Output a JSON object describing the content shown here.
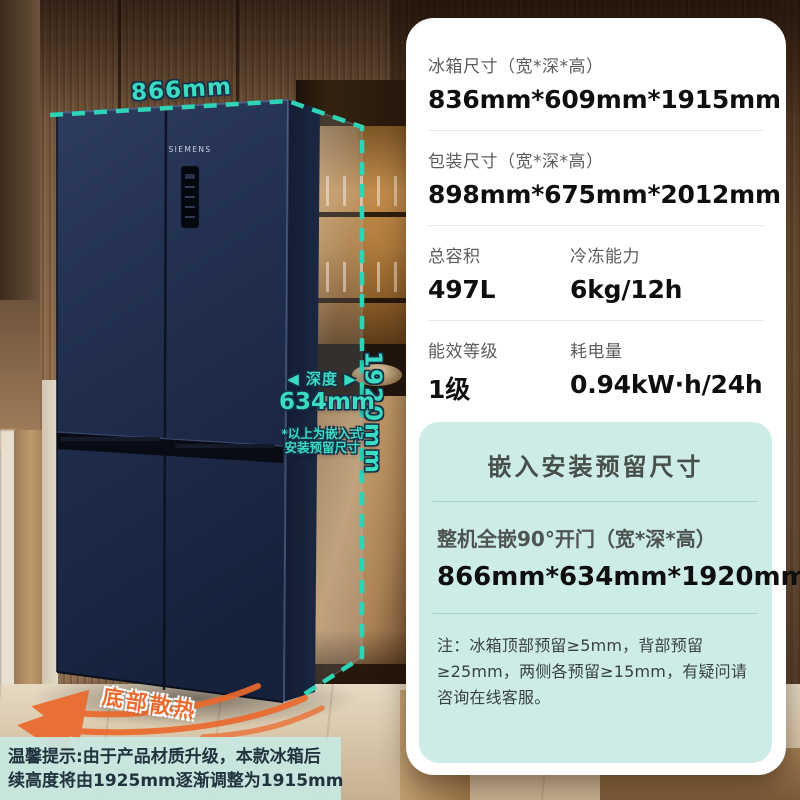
{
  "colors": {
    "accent_teal": "#3BDCC0",
    "dashed_line_teal": "#2FD3B6",
    "orange": "#EB6A2D",
    "embed_card_bg": "#CDECE7",
    "fridge_navy": "#1F2B4A"
  },
  "fridge": {
    "brand": "SIEMENS"
  },
  "measurements": {
    "width": "866mm",
    "height": "1920mm",
    "depth_dir": "◀ 深度 ▶",
    "depth_value": "634mm",
    "embed_note_line1": "*以上为嵌入式",
    "embed_note_line2": "安装预留尺寸",
    "vent": "底部散热"
  },
  "specs": {
    "rows": [
      {
        "label": "冰箱尺寸（宽*深*高）",
        "value": "836mm*609mm*1915mm"
      },
      {
        "label": "包装尺寸（宽*深*高）",
        "value": "898mm*675mm*2012mm"
      }
    ],
    "pairs": [
      [
        {
          "label": "总容积",
          "value": "497L"
        },
        {
          "label": "冷冻能力",
          "value": "6kg/12h"
        }
      ],
      [
        {
          "label": "能效等级",
          "value": "1级"
        },
        {
          "label": "耗电量",
          "value": "0.94kW·h/24h"
        }
      ]
    ]
  },
  "embed": {
    "title": "嵌入安装预留尺寸",
    "label": "整机全嵌90°开门（宽*深*高）",
    "value": "866mm*634mm*1920mm",
    "note": "注：冰箱顶部预留≥5mm，背部预留≥25mm，两侧各预留≥15mm，有疑问请咨询在线客服。"
  },
  "tip": {
    "line1": "温馨提示:由于产品材质升级，本款冰箱后",
    "line2": "续高度将由1925mm逐渐调整为1915mm"
  }
}
